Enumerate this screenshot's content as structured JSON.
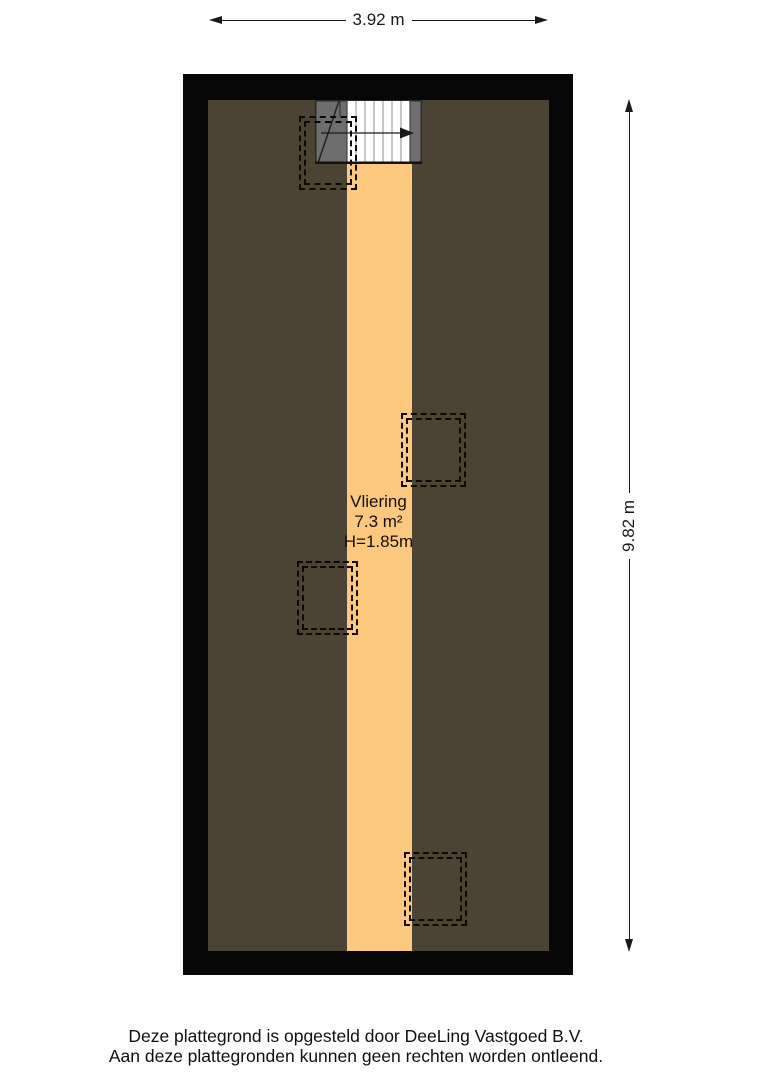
{
  "plan": {
    "room": {
      "name": "Vliering",
      "area": "7.3 m²",
      "height_clearance": "H=1.85m"
    },
    "dimensions": {
      "width": "3.92 m",
      "height": "9.82 m"
    },
    "colors": {
      "wall": "#070707",
      "floor": "#4B4334",
      "landing": "#FBC87D",
      "stair_gray": "#6E6E6E"
    }
  },
  "footer": {
    "line1": "Deze plattegrond is opgesteld door DeeLing Vastgoed B.V.",
    "line2": "Aan deze plattegronden kunnen geen rechten worden ontleend."
  }
}
